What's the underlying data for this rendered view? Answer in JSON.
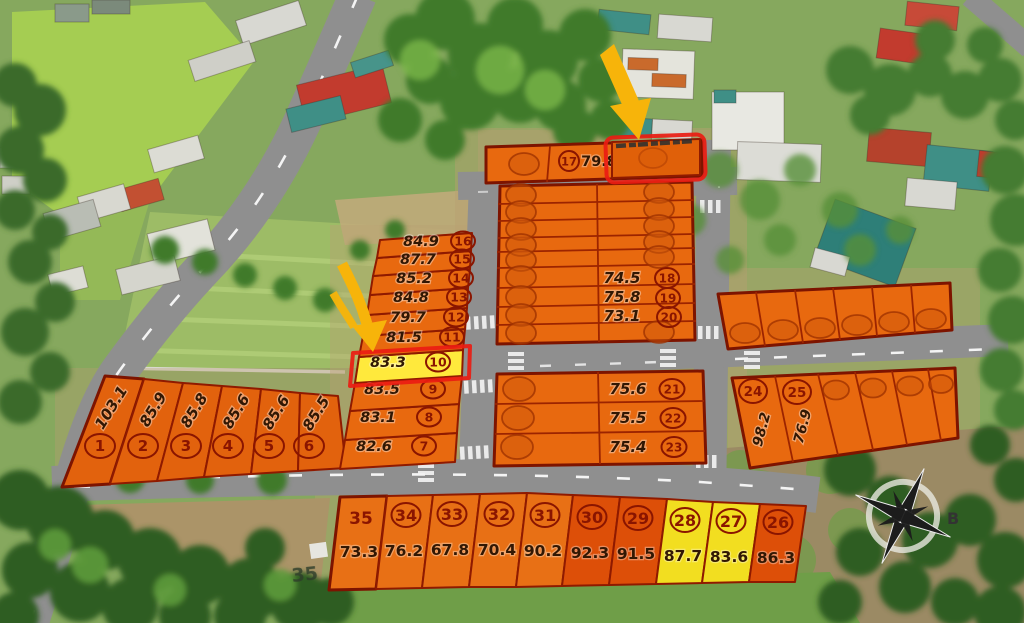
{
  "colors": {
    "plot_orange": "#e8690f",
    "plot_deep_orange": "#dd4f08",
    "plot_yellow": "#f2de20",
    "highlight_yellow": "#ffe93c",
    "highlight_red": "#ea1c12",
    "arrow_yellow": "#f7b40a",
    "road_gray": "#8f8f8f",
    "plot_number_red": "#8a1500",
    "area_text_dark": "#311703"
  },
  "compass": {
    "label": "B"
  },
  "ground_marking": "35",
  "top_strip": {
    "no": "17",
    "area": "79.8"
  },
  "left_block": {
    "plots": [
      {
        "no": "1",
        "area": "103.1"
      },
      {
        "no": "2",
        "area": "85.9"
      },
      {
        "no": "3",
        "area": "85.8"
      },
      {
        "no": "4",
        "area": "85.6"
      },
      {
        "no": "5",
        "area": "85.6"
      },
      {
        "no": "6",
        "area": "85.5"
      }
    ]
  },
  "middle_column": {
    "plots": [
      {
        "no": "7",
        "area": "82.6"
      },
      {
        "no": "8",
        "area": "83.1"
      },
      {
        "no": "9",
        "area": "83.5"
      },
      {
        "no": "10",
        "area": "83.3",
        "highlighted": true
      },
      {
        "no": "11",
        "area": "81.5"
      },
      {
        "no": "12",
        "area": "79.7"
      },
      {
        "no": "13",
        "area": "84.8"
      },
      {
        "no": "14",
        "area": "85.2"
      },
      {
        "no": "15",
        "area": "87.7"
      },
      {
        "no": "16",
        "area": "84.9"
      }
    ]
  },
  "central_block": {
    "plots": [
      {
        "no": "18",
        "area": "74.5"
      },
      {
        "no": "19",
        "area": "75.8"
      },
      {
        "no": "20",
        "area": "73.1"
      }
    ]
  },
  "lower_central_block": {
    "plots": [
      {
        "no": "21",
        "area": "75.6"
      },
      {
        "no": "22",
        "area": "75.5"
      },
      {
        "no": "23",
        "area": "75.4"
      }
    ]
  },
  "right_lower_block": {
    "plots": [
      {
        "no": "24",
        "area": "98.2"
      },
      {
        "no": "25",
        "area": "76.9"
      }
    ]
  },
  "bottom_row": {
    "plots": [
      {
        "no": "35",
        "area": "73.3"
      },
      {
        "no": "34",
        "area": "76.2"
      },
      {
        "no": "33",
        "area": "67.8"
      },
      {
        "no": "32",
        "area": "70.4"
      },
      {
        "no": "31",
        "area": "90.2"
      },
      {
        "no": "30",
        "area": "92.3"
      },
      {
        "no": "29",
        "area": "91.5"
      },
      {
        "no": "28",
        "area": "87.7",
        "status": "yellow"
      },
      {
        "no": "27",
        "area": "83.6",
        "status": "yellow"
      },
      {
        "no": "26",
        "area": "86.3"
      }
    ]
  }
}
